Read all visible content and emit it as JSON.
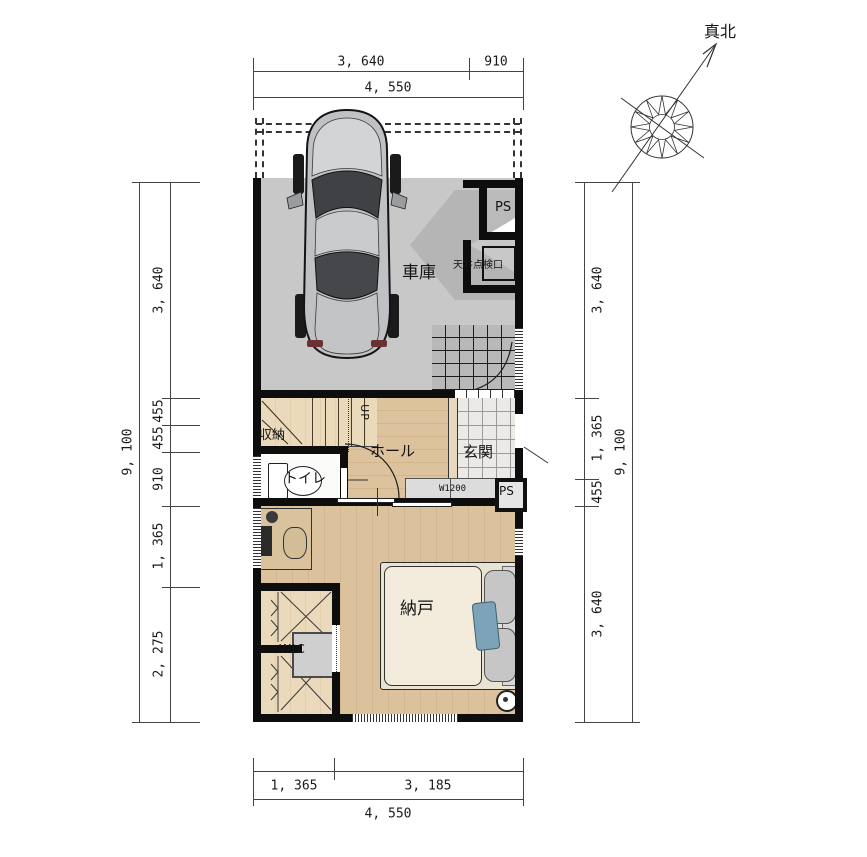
{
  "title": "1F間取り図(車庫付き住宅プラン)",
  "compass": {
    "label": "真北"
  },
  "rooms": {
    "garage": "車庫",
    "hall": "ホール",
    "entrance": "玄関",
    "toilet": "トイレ",
    "closet": "収納",
    "storeroom": "納戸",
    "wic": "WIC",
    "up": "UP"
  },
  "fixtures": {
    "ps": "PS",
    "inspection_hatch": "天井点検口",
    "shoe_cabinet": "W1200"
  },
  "dimensions": {
    "unit": "mm",
    "top": {
      "segments": [
        "3, 640",
        "910"
      ],
      "total": "4, 550"
    },
    "bottom": {
      "segments": [
        "1, 365",
        "3, 185"
      ],
      "total": "4, 550"
    },
    "left": {
      "segments": [
        "3, 640",
        "455",
        "455",
        "910",
        "1, 365",
        "2, 275"
      ],
      "total": "9, 100"
    },
    "right": {
      "segments": [
        "3, 640",
        "1, 365",
        "455",
        "3, 640"
      ],
      "total": "9, 100"
    }
  },
  "colors": {
    "wall": "#0d0d0d",
    "wood_floor": "#d9bd98",
    "garage_floor": "#c8c8c8",
    "entrance_tile": "#ebeae6",
    "accent_pillow_blue": "#7ca3b8"
  }
}
